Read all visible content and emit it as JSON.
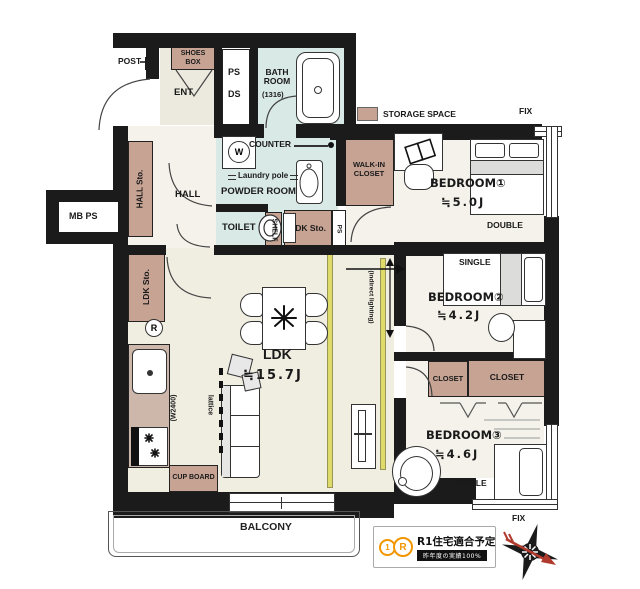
{
  "colors": {
    "wall": "#1b1b1b",
    "storage": "#c7a394",
    "wet_area": "#d9e9e6",
    "floor": "#f0ede1",
    "indirect_lighting": "#dfdb6b",
    "badge_orange": "#f29600",
    "compass_red": "#b03a2e"
  },
  "legend": {
    "storage_space": "STORAGE SPACE"
  },
  "exterior": {
    "post": "POST",
    "fix_top": "FIX",
    "fix_bottom": "FIX",
    "balcony": "BALCONY",
    "mb_ps": "MB PS"
  },
  "entrance": {
    "ent": "ENT",
    "shoes_box": "SHOES BOX",
    "ps": "PS",
    "ds": "DS"
  },
  "bathroom": {
    "name": "BATH ROOM",
    "size": "(1316)"
  },
  "powder_room": {
    "name": "POWDER ROOM",
    "counter": "COUNTER",
    "laundry_pole": "Laundry pole",
    "washer": "W"
  },
  "toilet": {
    "name": "TOILET",
    "shelf": "SHELF"
  },
  "hall": {
    "name": "HALL",
    "hall_sto": "HALL Sto."
  },
  "shafts": {
    "ps_small": "PS"
  },
  "kitchen": {
    "width_note": "(W2400)",
    "lattice": "lattice",
    "cup_board": "CUP BOARD",
    "fridge": "R"
  },
  "ldk": {
    "name": "LDK",
    "size": "≒15.7J",
    "ldk_sto_left": "LDK Sto.",
    "ldk_sto_hall": "LDK Sto.",
    "indirect_lighting": "(indirect lighting)"
  },
  "walk_in_closet": {
    "name": "WALK-IN CLOSET"
  },
  "bedroom1": {
    "name": "BEDROOM①",
    "size": "≒5.0J",
    "bed": "DOUBLE"
  },
  "bedroom2": {
    "name": "BEDROOM②",
    "size": "≒4.2J",
    "bed": "SINGLE",
    "closet": "CLOSET"
  },
  "bedroom3": {
    "name": "BEDROOM③",
    "size": "≒4.6J",
    "bed": "SINGLE",
    "closet": "CLOSET"
  },
  "badge": {
    "logo_1": "1",
    "logo_r": "R",
    "title": "R1住宅適合予定",
    "subtitle": "昨年度の実績100%"
  }
}
